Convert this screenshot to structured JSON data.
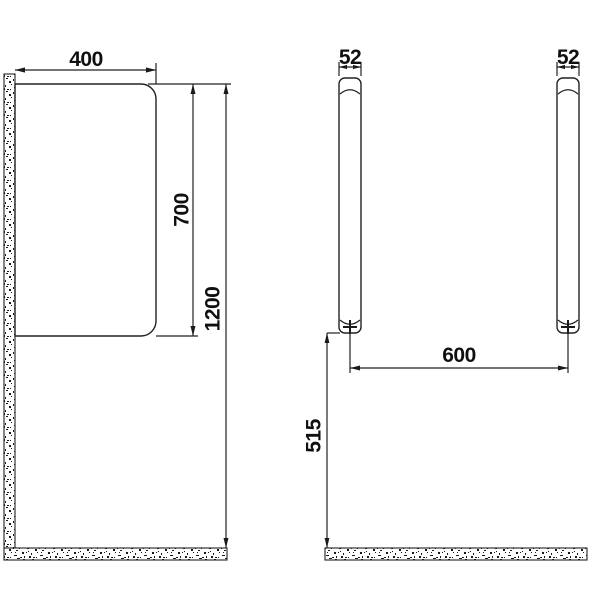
{
  "background": "#ffffff",
  "ink_color": "#1a1a1a",
  "drawing": {
    "front_view": {
      "width_label": "400",
      "panel_height_label": "700",
      "overall_height_label": "1200"
    },
    "side_view": {
      "left_bar_thickness_label": "52",
      "right_bar_thickness_label": "52",
      "span_label": "600",
      "floor_clearance_label": "515"
    }
  }
}
